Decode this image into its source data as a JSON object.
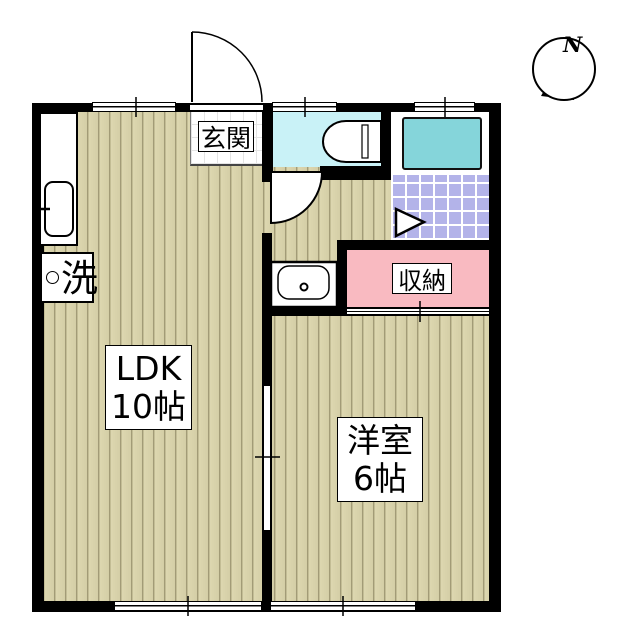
{
  "floor_plan": {
    "type": "apartment-floor-plan",
    "compass": {
      "label": "N"
    },
    "rooms": {
      "ldk": {
        "name": "LDK",
        "area": "10帖"
      },
      "western_room": {
        "name": "洋室",
        "area": "6帖"
      },
      "entrance": {
        "label": "玄関"
      },
      "storage": {
        "label": "収納"
      },
      "laundry": {
        "label": "洗"
      }
    },
    "colors": {
      "wall": "#000000",
      "wood_floor": "#d8d2ab",
      "entrance_tile": "#ffffff",
      "toilet_floor": "#c9f2f7",
      "bath_tile": "#b3b3e9",
      "bathtub": "#85d5da",
      "storage_fill": "#f9bac1",
      "fixture": "#ffffff"
    }
  }
}
